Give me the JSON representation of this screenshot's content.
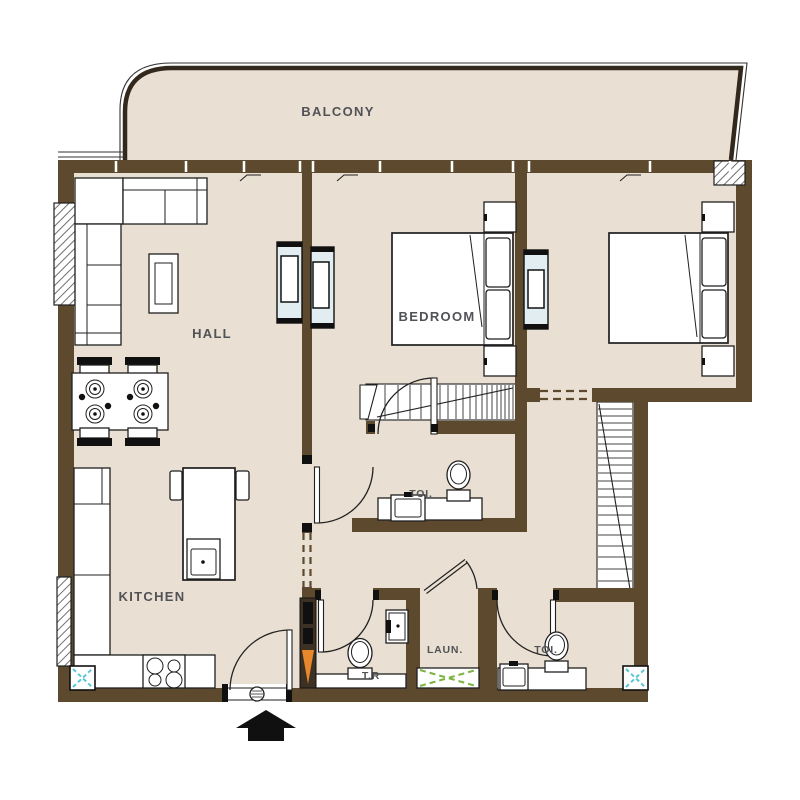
{
  "plan": {
    "labels": {
      "balcony": "BALCONY",
      "hall": "HALL",
      "bedroom": "BEDROOM",
      "kitchen": "KITCHEN",
      "toilet_upper": "TOI.",
      "laundry": "LAUN.",
      "toilet_lower": "TOI.",
      "powder_room": "T.R"
    },
    "colors": {
      "floor": "#e9dfd2",
      "wall": "#5d4a2e",
      "railing": "#32281c",
      "label_text": "#515256",
      "tv_unit_fill": "#e2edf2",
      "laundry_marker": "#7cb342",
      "duct_marker": "#56c5d6",
      "riser_marker": "#e8882d"
    }
  }
}
